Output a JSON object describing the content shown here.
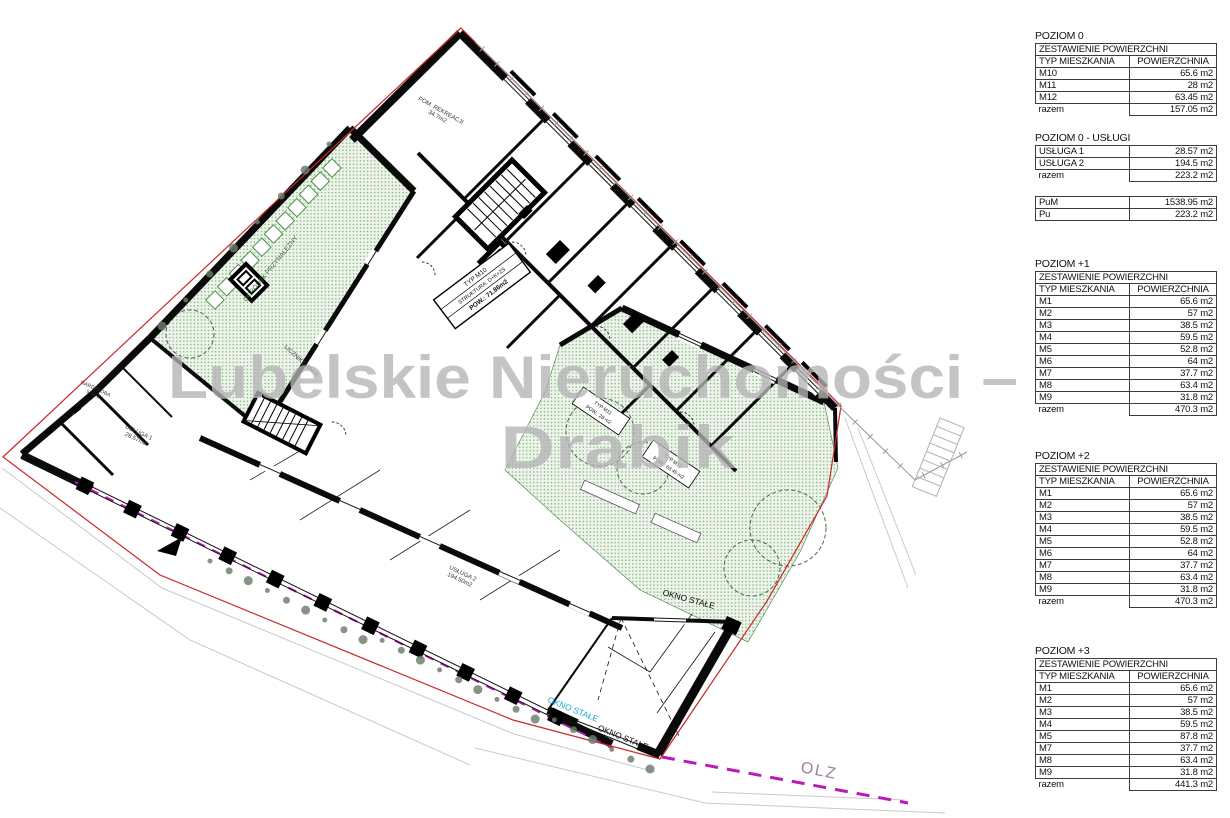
{
  "watermark": {
    "line1": "Lubelskie Nieruchomości –",
    "line2": "Drabik"
  },
  "plan": {
    "labels": {
      "pom_line1": "POM. REKREACJI",
      "pom_line2": "34.7m2",
      "licznikownia": "LICZNIKOWNIA",
      "garderoba_line1": "GARDEROBA",
      "garderoba_line2": "5.5m2",
      "usluga1_line1": "USŁUGA 1",
      "usluga1_line2": "28.57m2",
      "usluga2_line1": "USŁUGA 2",
      "usluga2_line2": "194.50m2",
      "ogrodek": "OGRÓDEK PRZYNALEŻNY",
      "okno_stale": "OKNO STAŁE",
      "olz": "OLZ",
      "m10_line1": "TYP M10",
      "m10_line2": "STRUKTURA: D+K+2S",
      "m10_line3": "POW.: 71.86m2",
      "m11_line1": "TYP M11",
      "m11_line2": "POW.: 28 m2",
      "m12_line1": "TYP M12",
      "m12_line2": "POW.: 63.45 m2"
    },
    "colors": {
      "boundary": "#cc2626",
      "garden_dot": "#7fae7f",
      "magenta": "#b81bb8",
      "cyan_label": "#19a8d8",
      "watermark": "#b4b4b4"
    }
  },
  "tables": [
    {
      "title": "POZIOM 0",
      "header": "ZESTAWIENIE POWIERZCHNI",
      "columns": [
        "TYP MIESZKANIA",
        "POWIERZCHNIA"
      ],
      "rows": [
        [
          "M10",
          "65.6 m2"
        ],
        [
          "M11",
          "28 m2"
        ],
        [
          "M12",
          "63.45 m2"
        ]
      ],
      "total": [
        "razem",
        "157.05 m2"
      ]
    },
    {
      "title": "POZIOM 0 - USŁUGI",
      "rows": [
        [
          "USŁUGA 1",
          "28.57 m2"
        ],
        [
          "USŁUGA 2",
          "194.5 m2"
        ]
      ],
      "total": [
        "razem",
        "223.2 m2"
      ]
    },
    {
      "rows": [
        [
          "PuM",
          "1538.95 m2"
        ],
        [
          "Pu",
          "223.2 m2"
        ]
      ]
    },
    {
      "title": "POZIOM +1",
      "header": "ZESTAWIENIE POWIERZCHNI",
      "columns": [
        "TYP MIESZKANIA",
        "POWIERZCHNIA"
      ],
      "rows": [
        [
          "M1",
          "65.6 m2"
        ],
        [
          "M2",
          "57 m2"
        ],
        [
          "M3",
          "38.5 m2"
        ],
        [
          "M4",
          "59.5 m2"
        ],
        [
          "M5",
          "52.8 m2"
        ],
        [
          "M6",
          "64 m2"
        ],
        [
          "M7",
          "37.7 m2"
        ],
        [
          "M8",
          "63.4 m2"
        ],
        [
          "M9",
          "31.8 m2"
        ]
      ],
      "total": [
        "razem",
        "470.3 m2"
      ]
    },
    {
      "title": "POZIOM +2",
      "header": "ZESTAWIENIE POWIERZCHNI",
      "columns": [
        "TYP MIESZKANIA",
        "POWIERZCHNIA"
      ],
      "rows": [
        [
          "M1",
          "65.6 m2"
        ],
        [
          "M2",
          "57 m2"
        ],
        [
          "M3",
          "38.5 m2"
        ],
        [
          "M4",
          "59.5 m2"
        ],
        [
          "M5",
          "52.8 m2"
        ],
        [
          "M6",
          "64 m2"
        ],
        [
          "M7",
          "37.7 m2"
        ],
        [
          "M8",
          "63.4 m2"
        ],
        [
          "M9",
          "31.8 m2"
        ]
      ],
      "total": [
        "razem",
        "470.3 m2"
      ]
    },
    {
      "title": "POZIOM +3",
      "header": "ZESTAWIENIE POWIERZCHNI",
      "columns": [
        "TYP MIESZKANIA",
        "POWIERZCHNIA"
      ],
      "rows": [
        [
          "M1",
          "65.6 m2"
        ],
        [
          "M2",
          "57 m2"
        ],
        [
          "M3",
          "38.5 m2"
        ],
        [
          "M4",
          "59.5 m2"
        ],
        [
          "M5",
          "87.8 m2"
        ],
        [
          "M7",
          "37.7 m2"
        ],
        [
          "M8",
          "63.4 m2"
        ],
        [
          "M9",
          "31.8 m2"
        ]
      ],
      "total": [
        "razem",
        "441.3 m2"
      ]
    }
  ]
}
